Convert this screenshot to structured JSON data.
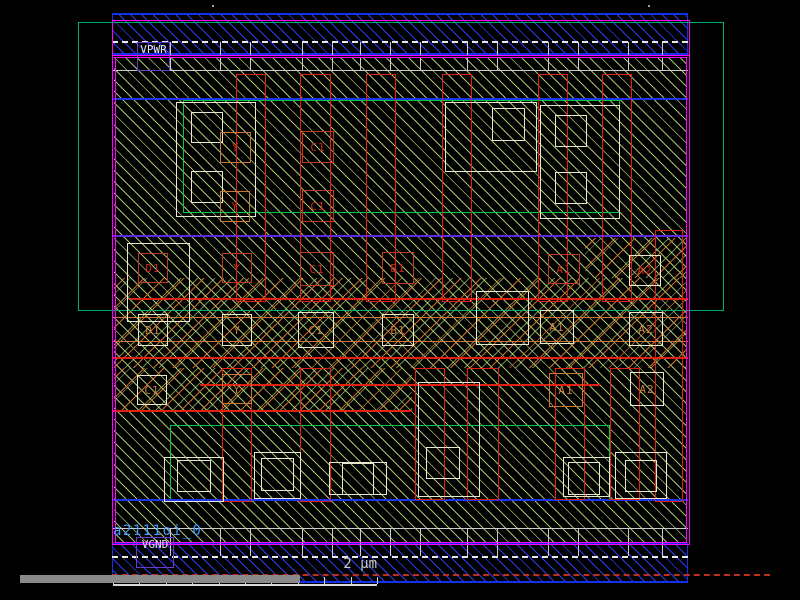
{
  "app": {
    "name": "ic-layout-viewer"
  },
  "cell": {
    "instance_label": "a2111oi_0"
  },
  "power_labels": {
    "top": "VPWR",
    "bottom": "VGND"
  },
  "scale_bar": {
    "label": "2 µm"
  },
  "colors": {
    "background": "#000000",
    "cell_boundary": "#ff00ff",
    "metal1_rail": "#2a3cf0",
    "nwell_outline": "#00ad72",
    "implant_green": "#00cc3d",
    "diffusion_hatch": "#bee280",
    "poly_red": "#e02010",
    "xhatch_orange": "#d4702a",
    "contact_white": "#e8e8cc",
    "label_purple": "#6a3ad0",
    "instance_text": "#3f9dff",
    "scale_text": "#c9c9c9",
    "scrollbar_gray": "#8a8a8a"
  },
  "pin_labels": [
    {
      "text": "C1",
      "box": [
        302,
        131,
        32,
        32
      ],
      "bc": "pb-red",
      "tc": "pt-red"
    },
    {
      "text": "C1",
      "box": [
        302,
        190,
        32,
        32
      ],
      "bc": "pb-red",
      "tc": "pt-red"
    },
    {
      "text": "Y",
      "box": [
        220,
        132,
        31,
        31
      ],
      "bc": "pb-orange",
      "tc": "pt-red"
    },
    {
      "text": "Y",
      "box": [
        220,
        191,
        30,
        31
      ],
      "bc": "pb-orange",
      "tc": "pt-red"
    },
    {
      "text": "D1",
      "box": [
        138,
        253,
        30,
        30
      ],
      "bc": "pb-red",
      "tc": "pt-red"
    },
    {
      "text": "Y",
      "box": [
        222,
        253,
        30,
        30
      ],
      "bc": "pb-red",
      "tc": "pt-red"
    },
    {
      "text": "C1",
      "box": [
        300,
        252,
        34,
        34
      ],
      "bc": "pb-red",
      "tc": "pt-red"
    },
    {
      "text": "B1",
      "box": [
        382,
        252,
        32,
        32
      ],
      "bc": "pb-red",
      "tc": "pt-red"
    },
    {
      "text": "A1",
      "box": [
        548,
        254,
        32,
        30
      ],
      "bc": "pb-red",
      "tc": "pt-red"
    },
    {
      "text": "A2",
      "box": [
        629,
        255,
        32,
        31
      ],
      "bc": "pb-white",
      "tc": "pt-red"
    },
    {
      "text": "D1",
      "box": [
        138,
        314,
        30,
        32
      ],
      "bc": "pb-white",
      "tc": "pt-orange"
    },
    {
      "text": "Y",
      "box": [
        222,
        314,
        30,
        32
      ],
      "bc": "pb-white",
      "tc": "pt-orange"
    },
    {
      "text": "C1",
      "box": [
        298,
        312,
        36,
        36
      ],
      "bc": "pb-white",
      "tc": "pt-orange"
    },
    {
      "text": "B1",
      "box": [
        382,
        314,
        32,
        32
      ],
      "bc": "pb-white",
      "tc": "pt-orange"
    },
    {
      "text": "A1",
      "box": [
        540,
        310,
        34,
        34
      ],
      "bc": "pb-white",
      "tc": "pt-orange"
    },
    {
      "text": "A2",
      "box": [
        629,
        312,
        34,
        34
      ],
      "bc": "pb-white",
      "tc": "pt-orange"
    },
    {
      "text": "C1",
      "box": [
        137,
        375,
        30,
        30
      ],
      "bc": "pb-white",
      "tc": "pt-orange"
    },
    {
      "text": "Y",
      "box": [
        222,
        374,
        30,
        30
      ],
      "bc": "pb-orange",
      "tc": "pt-orange"
    },
    {
      "text": "A1",
      "box": [
        549,
        373,
        34,
        34
      ],
      "bc": "pb-orange",
      "tc": "pt-orange"
    },
    {
      "text": "A2",
      "box": [
        630,
        372,
        34,
        34
      ],
      "bc": "pb-white",
      "tc": "pt-orange"
    }
  ],
  "geometry": {
    "interior": [
      114,
      57,
      572,
      486
    ],
    "rails": [
      [
        112,
        13,
        576,
        42
      ],
      [
        112,
        543,
        576,
        40
      ]
    ],
    "xhatch_zones": [
      [
        585,
        238,
        101,
        40
      ],
      [
        114,
        278,
        572,
        90
      ],
      [
        114,
        368,
        298,
        42
      ]
    ],
    "nwell": [
      78,
      22,
      644,
      287
    ],
    "magenta_borders": [
      [
        112,
        20,
        576,
        523
      ],
      [
        112,
        55,
        576,
        488
      ],
      [
        115,
        57,
        570,
        484
      ]
    ],
    "green_rects": [
      [
        183,
        100,
        435,
        111
      ],
      [
        170,
        425,
        438,
        74
      ]
    ],
    "white_rects": [
      [
        176,
        102,
        78,
        113
      ],
      [
        191,
        112,
        30,
        29
      ],
      [
        191,
        171,
        30,
        30
      ],
      [
        445,
        102,
        90,
        68
      ],
      [
        492,
        108,
        31,
        31
      ],
      [
        540,
        105,
        78,
        112
      ],
      [
        555,
        115,
        30,
        30
      ],
      [
        555,
        172,
        30,
        30
      ],
      [
        127,
        243,
        61,
        77
      ],
      [
        476,
        291,
        51,
        52
      ],
      [
        418,
        382,
        60,
        113
      ],
      [
        426,
        447,
        32,
        30
      ],
      [
        164,
        457,
        58,
        43
      ],
      [
        177,
        460,
        32,
        30
      ],
      [
        254,
        452,
        45,
        45
      ],
      [
        261,
        458,
        31,
        31
      ],
      [
        329,
        462,
        56,
        31
      ],
      [
        342,
        463,
        30,
        30
      ],
      [
        615,
        452,
        50,
        45
      ],
      [
        625,
        460,
        30,
        30
      ],
      [
        563,
        457,
        45,
        38
      ],
      [
        568,
        462,
        30,
        31
      ]
    ],
    "red_rects": [
      [
        236,
        74,
        28,
        226
      ],
      [
        300,
        74,
        29,
        226
      ],
      [
        366,
        74,
        28,
        226
      ],
      [
        442,
        74,
        28,
        226
      ],
      [
        538,
        74,
        28,
        226
      ],
      [
        602,
        74,
        28,
        226
      ],
      [
        222,
        368,
        28,
        132
      ],
      [
        300,
        368,
        29,
        132
      ],
      [
        415,
        368,
        28,
        130
      ],
      [
        467,
        368,
        30,
        130
      ],
      [
        555,
        368,
        28,
        130
      ],
      [
        610,
        368,
        28,
        130
      ],
      [
        655,
        230,
        26,
        270
      ]
    ],
    "red_hlines": [
      [
        130,
        298,
        558
      ],
      [
        112,
        357,
        576
      ],
      [
        200,
        384,
        400
      ],
      [
        112,
        410,
        300
      ]
    ],
    "orange_hlines": [
      [
        112,
        317,
        576
      ],
      [
        112,
        341,
        576
      ]
    ],
    "blue_hlines": [
      [
        112,
        98,
        576
      ],
      [
        112,
        499,
        576
      ]
    ],
    "purple_hlines": [
      [
        112,
        235,
        576
      ]
    ],
    "contact_divider_xs": [
      170,
      220,
      250,
      302,
      332,
      360,
      390,
      420,
      467,
      497,
      548,
      578,
      628,
      662
    ],
    "contact_rows": [
      {
        "y": 42,
        "h": 13
      },
      {
        "y": 57,
        "h": 13
      },
      {
        "y": 528,
        "h": 15
      },
      {
        "y": 543,
        "h": 13
      }
    ],
    "contact_hlines": [
      [
        112,
        70,
        576
      ],
      [
        112,
        528,
        576
      ]
    ],
    "dashed_white": [
      [
        112,
        41,
        576
      ],
      [
        112,
        556,
        576
      ]
    ],
    "dashed_red": [
      [
        112,
        574,
        658
      ]
    ],
    "scrollbar": [
      20,
      575,
      280,
      8
    ],
    "power_boxes": {
      "top": [
        137,
        42,
        33,
        29
      ],
      "bottom": [
        136,
        537,
        38,
        31
      ]
    },
    "instance_label_pos": [
      113,
      523
    ],
    "scale_label_pos": [
      300,
      556,
      77
    ],
    "ruler": {
      "x": 113,
      "y": 584,
      "w": 264,
      "ticks": [
        0,
        26,
        53,
        79,
        106,
        132,
        158,
        185,
        211,
        238,
        264
      ]
    },
    "dots": [
      [
        212,
        5
      ],
      [
        648,
        5
      ]
    ]
  }
}
